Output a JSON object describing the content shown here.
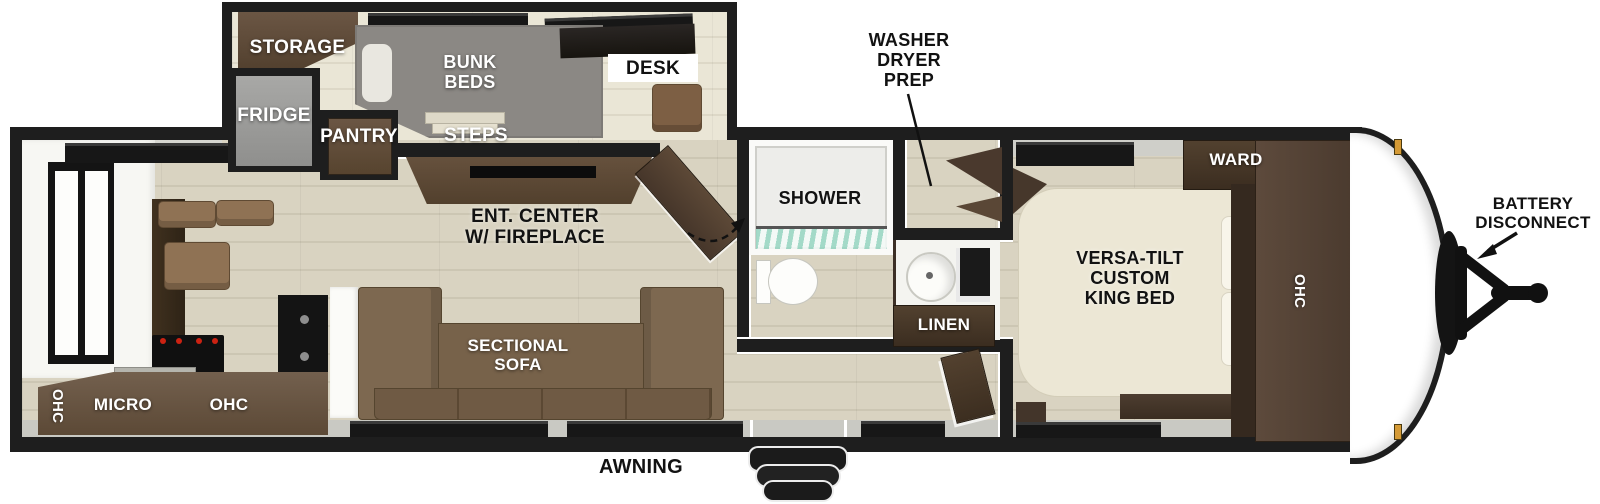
{
  "labels": {
    "storage": "STORAGE",
    "fridge": "FRIDGE",
    "pantry": "PANTRY",
    "bunk_beds": "BUNK\nBEDS",
    "steps": "STEPS",
    "desk": "DESK",
    "washer_dryer_prep": "WASHER\nDRYER\nPREP",
    "shower": "SHOWER",
    "ent_center": "ENT. CENTER\nW/ FIREPLACE",
    "sectional_sofa": "SECTIONAL\nSOFA",
    "linen": "LINEN",
    "ward": "WARD",
    "king_bed": "VERSA-TILT\nCUSTOM\nKING BED",
    "ohc_bedroom": "OHC",
    "ohc_kitchen_left": "OHC",
    "micro": "MICRO",
    "ohc_kitchen_right": "OHC",
    "awning": "AWNING",
    "battery_disconnect": "BATTERY\nDISCONNECT"
  },
  "colors": {
    "wall": "#1e1e1e",
    "floor": "#d9d3c1",
    "floor_line": "#ccc6b3",
    "slide_floor": "#eae6d6",
    "cabinet_dark": "#3b2d20",
    "cabinet_mid": "#6b5644",
    "sofa": "#7d6850",
    "bunk_gray": "#8b8884",
    "fridge_gray": "#9b9b99",
    "bed_cream": "#ece7d5",
    "shower_glass": "#96d6c2",
    "exterior_band": "#c9c9c3",
    "marker_light": "#d59a35",
    "label_white": "#ffffff",
    "label_black": "#121212"
  }
}
